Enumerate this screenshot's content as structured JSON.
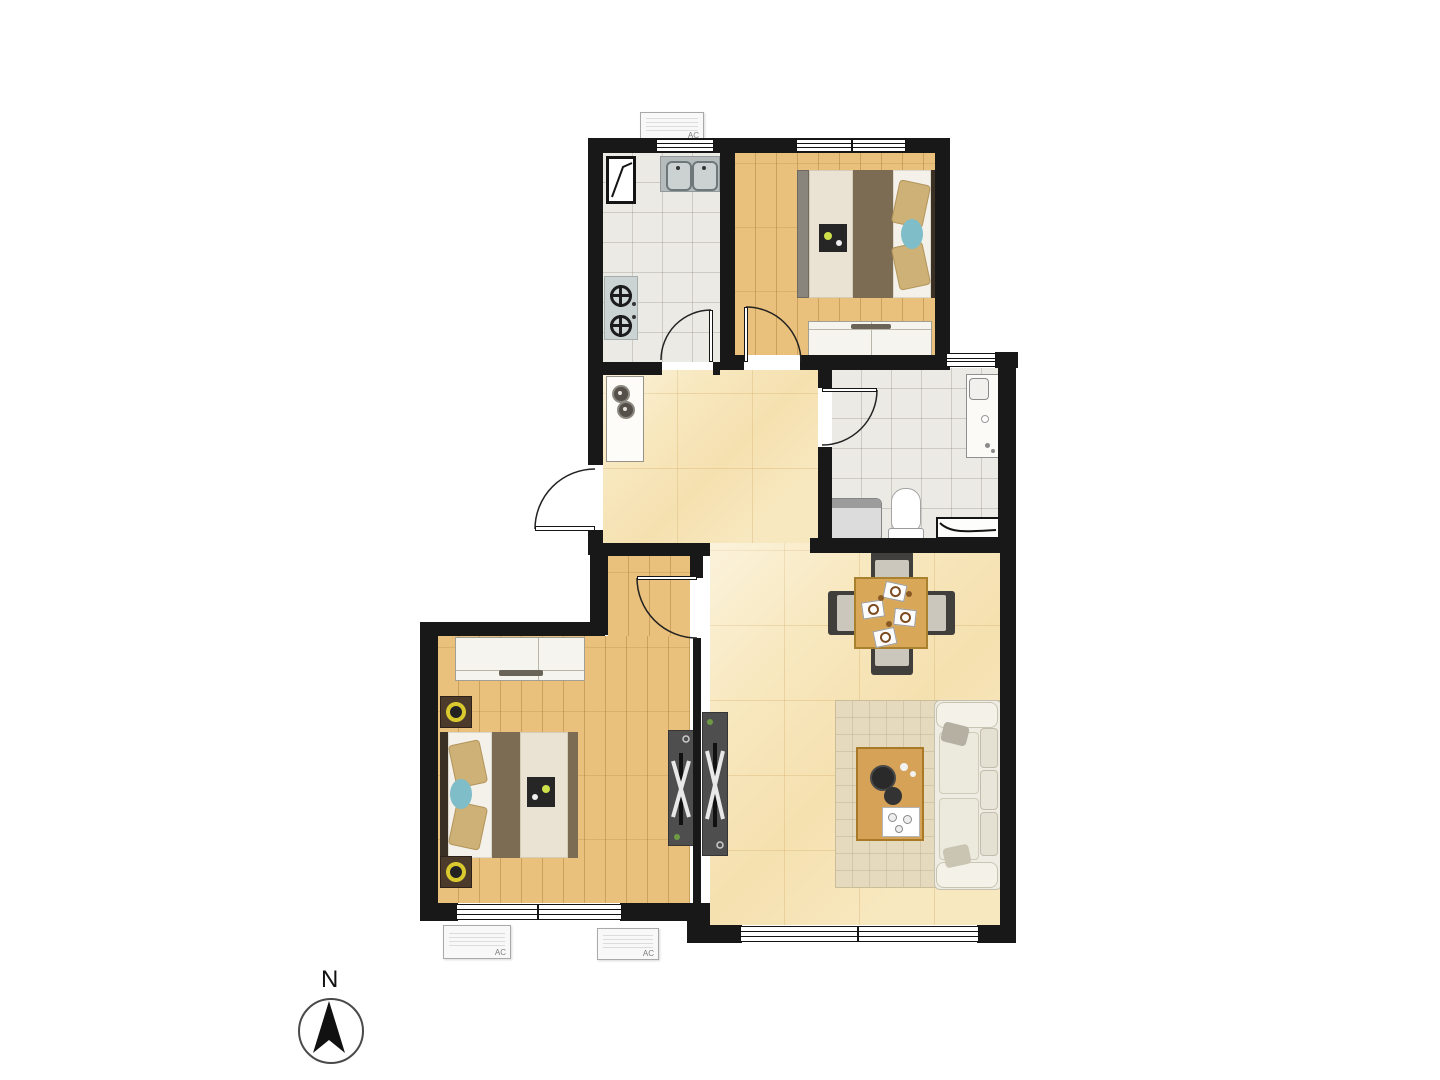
{
  "labels": {
    "ac_unit": "AC",
    "compass_north": "N"
  },
  "plan": {
    "type": "apartment-floor-plan",
    "orientation": "north-up",
    "rooms": [
      "kitchen",
      "north-bedroom",
      "bathroom",
      "foyer",
      "living-dining-room",
      "master-bedroom"
    ],
    "furniture": {
      "kitchen": [
        "casement-window",
        "double-sink",
        "gas-cooktop-2-burner"
      ],
      "north-bedroom": [
        "double-bed",
        "wardrobe"
      ],
      "bathroom": [
        "vanity-sink",
        "washing-machine",
        "toilet",
        "drain-tray"
      ],
      "foyer": [
        "entry-cabinet-with-vases"
      ],
      "living-dining-room": [
        "dining-table-4-chairs",
        "rug",
        "coffee-table",
        "sofa",
        "tv-console"
      ],
      "master-bedroom": [
        "double-bed",
        "two-nightstands-with-lamps",
        "wardrobe",
        "tv-console"
      ]
    },
    "counts": {
      "ac_units": 3,
      "windows": 5,
      "door_swings": 5
    }
  },
  "colors": {
    "wall": "#181818",
    "wood_floor": "#e9c17c",
    "gray_tile_floor": "#eceae5",
    "yellow_tile_floor": "#f8e8bf",
    "duvet_brown": "#7d6c54",
    "table_wood": "#d8a757",
    "sofa_cream": "#efede3",
    "lamp_yellow": "#d9c92e",
    "cushion_blue": "#7fbdc9",
    "console_gray": "#4e4e4e"
  }
}
